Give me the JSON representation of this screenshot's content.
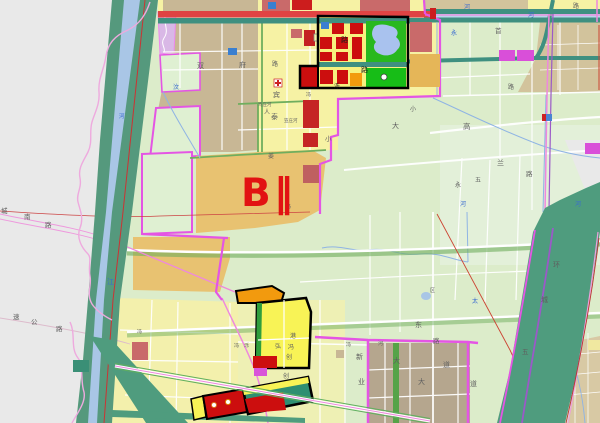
{
  "map": {
    "region_label": "B‖",
    "palette": {
      "outside_gray": "#e9e9e9",
      "fields_green": "#dcecca",
      "residential_yellow": "#f6f2a4",
      "urban_tan": "#c8b795",
      "golden_zone": "#e8c271",
      "commercial_red": "#cc0e0e",
      "rose_block": "#c96a6a",
      "park_green": "#28b81e",
      "water_blue": "#a9c6e6",
      "river_corridor_green": "#55997d",
      "canal_teal": "#3f9080",
      "boundary_magenta": "#e455e4",
      "road_pink": "#ee88dd",
      "village_brown": "#b5a68e",
      "orange_block": "#f29a0e",
      "label_red": "#e21212"
    },
    "labels": [
      {
        "t": "河",
        "x": 464,
        "y": 9,
        "c": "blue",
        "s": 6
      },
      {
        "t": "路",
        "x": 573,
        "y": 8,
        "c": "gray",
        "s": 6
      },
      {
        "t": "双",
        "x": 197,
        "y": 68,
        "c": "gray",
        "s": 7
      },
      {
        "t": "府",
        "x": 239,
        "y": 67,
        "c": "gray",
        "s": 7
      },
      {
        "t": "路",
        "x": 272,
        "y": 66,
        "c": "gray",
        "s": 6
      },
      {
        "t": "路",
        "x": 341,
        "y": 42,
        "c": "black",
        "s": 7
      },
      {
        "t": "路",
        "x": 361,
        "y": 72,
        "c": "black",
        "s": 7
      },
      {
        "t": "泺",
        "x": 334,
        "y": 88,
        "c": "black",
        "s": 6
      },
      {
        "t": "首",
        "x": 495,
        "y": 33,
        "c": "gray",
        "s": 6.5
      },
      {
        "t": "永",
        "x": 451,
        "y": 35,
        "c": "blue",
        "s": 6
      },
      {
        "t": "河",
        "x": 528,
        "y": 17,
        "c": "blue",
        "s": 6
      },
      {
        "t": "汶",
        "x": 173,
        "y": 89,
        "c": "blue",
        "s": 6
      },
      {
        "t": "宾",
        "x": 273,
        "y": 97,
        "c": "gray",
        "s": 7
      },
      {
        "t": "笃庄河",
        "x": 258,
        "y": 106,
        "c": "gray",
        "s": 4.5
      },
      {
        "t": "人",
        "x": 264,
        "y": 114,
        "c": "gray",
        "s": 6
      },
      {
        "t": "泰",
        "x": 271,
        "y": 119,
        "c": "gray",
        "s": 7
      },
      {
        "t": "笠庄河",
        "x": 284,
        "y": 122,
        "c": "gray",
        "s": 4.5
      },
      {
        "t": "姜",
        "x": 268,
        "y": 158,
        "c": "gray",
        "s": 6
      },
      {
        "t": "小",
        "x": 325,
        "y": 141,
        "c": "gray",
        "s": 6.5
      },
      {
        "t": "大",
        "x": 392,
        "y": 128,
        "c": "gray",
        "s": 7
      },
      {
        "t": "高",
        "x": 463,
        "y": 129,
        "c": "gray",
        "s": 7.5
      },
      {
        "t": "小",
        "x": 410,
        "y": 111,
        "c": "gray",
        "s": 6
      },
      {
        "t": "路",
        "x": 508,
        "y": 89,
        "c": "gray",
        "s": 6
      },
      {
        "t": "冯",
        "x": 306,
        "y": 96,
        "c": "gray",
        "s": 5
      },
      {
        "t": "冯",
        "x": 286,
        "y": 208,
        "c": "gray",
        "s": 5
      },
      {
        "t": "兰",
        "x": 497,
        "y": 165,
        "c": "gray",
        "s": 7
      },
      {
        "t": "路",
        "x": 526,
        "y": 176,
        "c": "gray",
        "s": 6.5
      },
      {
        "t": "永",
        "x": 455,
        "y": 187,
        "c": "gray",
        "s": 6
      },
      {
        "t": "五",
        "x": 475,
        "y": 182,
        "c": "gray",
        "s": 6
      },
      {
        "t": "河",
        "x": 460,
        "y": 206,
        "c": "blue",
        "s": 6
      },
      {
        "t": "河",
        "x": 575,
        "y": 206,
        "c": "blue",
        "s": 6
      },
      {
        "t": "环",
        "x": 553,
        "y": 267,
        "c": "gray",
        "s": 7
      },
      {
        "t": "城",
        "x": 541,
        "y": 302,
        "c": "gray",
        "s": 7
      },
      {
        "t": "五",
        "x": 522,
        "y": 354,
        "c": "gray",
        "s": 6.5
      },
      {
        "t": "东",
        "x": 415,
        "y": 327,
        "c": "gray",
        "s": 7
      },
      {
        "t": "区",
        "x": 430,
        "y": 292,
        "c": "gray",
        "s": 5
      },
      {
        "t": "太",
        "x": 472,
        "y": 303,
        "c": "blue",
        "s": 6
      },
      {
        "t": "路",
        "x": 433,
        "y": 343,
        "c": "gray",
        "s": 6.5
      },
      {
        "t": "大",
        "x": 393,
        "y": 363,
        "c": "gray",
        "s": 7
      },
      {
        "t": "道",
        "x": 443,
        "y": 367,
        "c": "gray",
        "s": 7
      },
      {
        "t": "大",
        "x": 418,
        "y": 384,
        "c": "gray",
        "s": 7
      },
      {
        "t": "道",
        "x": 470,
        "y": 386,
        "c": "gray",
        "s": 7
      },
      {
        "t": "新",
        "x": 356,
        "y": 359,
        "c": "gray",
        "s": 7
      },
      {
        "t": "业",
        "x": 358,
        "y": 384,
        "c": "gray",
        "s": 7
      },
      {
        "t": "冯",
        "x": 346,
        "y": 346,
        "c": "gray",
        "s": 5
      },
      {
        "t": "河",
        "x": 378,
        "y": 345,
        "c": "gray",
        "s": 5
      },
      {
        "t": "城",
        "x": 1,
        "y": 213,
        "c": "gray",
        "s": 6.5
      },
      {
        "t": "南",
        "x": 24,
        "y": 219,
        "c": "gray",
        "s": 6.5
      },
      {
        "t": "路",
        "x": 45,
        "y": 227,
        "c": "gray",
        "s": 6.5
      },
      {
        "t": "速",
        "x": 13,
        "y": 319,
        "c": "gray",
        "s": 6.5
      },
      {
        "t": "公",
        "x": 31,
        "y": 324,
        "c": "gray",
        "s": 6.5
      },
      {
        "t": "路",
        "x": 56,
        "y": 331,
        "c": "gray",
        "s": 6.5
      },
      {
        "t": "江",
        "x": 107,
        "y": 284,
        "c": "blue",
        "s": 7
      },
      {
        "t": "河",
        "x": 119,
        "y": 118,
        "c": "blue",
        "s": 5.5
      },
      {
        "t": "港",
        "x": 290,
        "y": 338,
        "c": "gray",
        "s": 6
      },
      {
        "t": "冯",
        "x": 288,
        "y": 349,
        "c": "gray",
        "s": 6
      },
      {
        "t": "弘",
        "x": 275,
        "y": 348,
        "c": "gray",
        "s": 6
      },
      {
        "t": "创",
        "x": 286,
        "y": 359,
        "c": "gray",
        "s": 6
      },
      {
        "t": "创",
        "x": 283,
        "y": 378,
        "c": "gray",
        "s": 6
      },
      {
        "t": "冯",
        "x": 234,
        "y": 347,
        "c": "gray",
        "s": 5
      },
      {
        "t": "泺",
        "x": 244,
        "y": 347,
        "c": "gray",
        "s": 5
      },
      {
        "t": "冯",
        "x": 137,
        "y": 333,
        "c": "gray",
        "s": 5
      }
    ]
  }
}
